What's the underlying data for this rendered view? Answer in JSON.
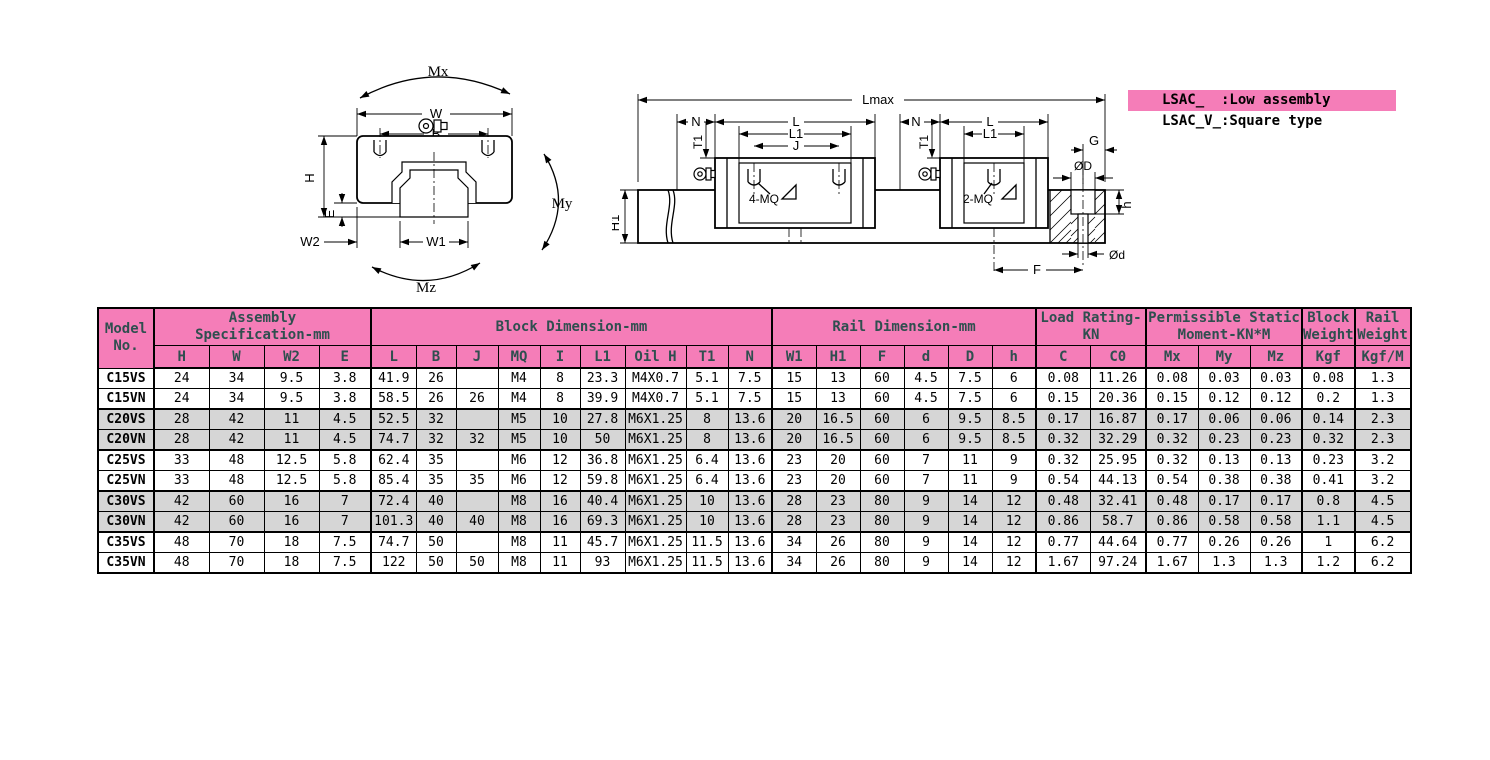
{
  "colors": {
    "header_pink": "#f57db8",
    "legend_pink": "#f78bc0",
    "row_shade": "#d6d6d6",
    "header_text": "#2f4f4f"
  },
  "legend": {
    "line1": "LSAC_  :Low assembly",
    "line2": "LSAC_V_:Square type"
  },
  "diagram": {
    "front_view": {
      "mx": "Mx",
      "w": "W",
      "b": "B",
      "my": "My",
      "h": "H",
      "e": "E",
      "w2": "W2",
      "w1": "W1",
      "mz": "Mz"
    },
    "side_view": {
      "lmax": "Lmax",
      "n_left": "N",
      "t1_left": "T1",
      "l_left": "L",
      "l1_left": "L1",
      "j": "J",
      "mq4": "4-MQ",
      "h1": "H1",
      "n_right": "N",
      "t1_right": "T1",
      "l_right": "L",
      "l1_right": "L1",
      "mq2": "2-MQ",
      "g": "G",
      "dia_D": "ØD",
      "h": "h",
      "dia_d": "Ød",
      "f": "F"
    }
  },
  "table": {
    "model_header": {
      "l1": "Model",
      "l2": "No."
    },
    "groups": [
      {
        "l1": "Assembly",
        "l2": "Specification-mm"
      },
      {
        "l1": "Block Dimension-mm",
        "l2": ""
      },
      {
        "l1": "Rail Dimension-mm",
        "l2": ""
      },
      {
        "l1": "Load Rating-",
        "l2": "KN"
      },
      {
        "l1": "Permissible Static",
        "l2": "Moment-KN*M"
      },
      {
        "l1": "Block",
        "l2": "Weight"
      },
      {
        "l1": "Rail",
        "l2": "Weight"
      }
    ],
    "sub_headers": [
      "H",
      "W",
      "W2",
      "E",
      "L",
      "B",
      "J",
      "MQ",
      "I",
      "L1",
      "Oil H",
      "T1",
      "N",
      "W1",
      "H1",
      "F",
      "d",
      "D",
      "h",
      "C",
      "C0",
      "Mx",
      "My",
      "Mz",
      "Kgf",
      "Kgf/M"
    ],
    "rows": [
      {
        "model": "C15VS",
        "shaded": false,
        "values": [
          "24",
          "34",
          "9.5",
          "3.8",
          "41.9",
          "26",
          "",
          "M4",
          "8",
          "23.3",
          "M4X0.7",
          "5.1",
          "7.5",
          "15",
          "13",
          "60",
          "4.5",
          "7.5",
          "6",
          "0.08",
          "11.26",
          "0.08",
          "0.03",
          "0.03",
          "0.08",
          "1.3"
        ]
      },
      {
        "model": "C15VN",
        "shaded": false,
        "values": [
          "24",
          "34",
          "9.5",
          "3.8",
          "58.5",
          "26",
          "26",
          "M4",
          "8",
          "39.9",
          "M4X0.7",
          "5.1",
          "7.5",
          "15",
          "13",
          "60",
          "4.5",
          "7.5",
          "6",
          "0.15",
          "20.36",
          "0.15",
          "0.12",
          "0.12",
          "0.2",
          "1.3"
        ]
      },
      {
        "model": "C20VS",
        "shaded": true,
        "values": [
          "28",
          "42",
          "11",
          "4.5",
          "52.5",
          "32",
          "",
          "M5",
          "10",
          "27.8",
          "M6X1.25",
          "8",
          "13.6",
          "20",
          "16.5",
          "60",
          "6",
          "9.5",
          "8.5",
          "0.17",
          "16.87",
          "0.17",
          "0.06",
          "0.06",
          "0.14",
          "2.3"
        ]
      },
      {
        "model": "C20VN",
        "shaded": true,
        "values": [
          "28",
          "42",
          "11",
          "4.5",
          "74.7",
          "32",
          "32",
          "M5",
          "10",
          "50",
          "M6X1.25",
          "8",
          "13.6",
          "20",
          "16.5",
          "60",
          "6",
          "9.5",
          "8.5",
          "0.32",
          "32.29",
          "0.32",
          "0.23",
          "0.23",
          "0.32",
          "2.3"
        ]
      },
      {
        "model": "C25VS",
        "shaded": false,
        "values": [
          "33",
          "48",
          "12.5",
          "5.8",
          "62.4",
          "35",
          "",
          "M6",
          "12",
          "36.8",
          "M6X1.25",
          "6.4",
          "13.6",
          "23",
          "20",
          "60",
          "7",
          "11",
          "9",
          "0.32",
          "25.95",
          "0.32",
          "0.13",
          "0.13",
          "0.23",
          "3.2"
        ]
      },
      {
        "model": "C25VN",
        "shaded": false,
        "values": [
          "33",
          "48",
          "12.5",
          "5.8",
          "85.4",
          "35",
          "35",
          "M6",
          "12",
          "59.8",
          "M6X1.25",
          "6.4",
          "13.6",
          "23",
          "20",
          "60",
          "7",
          "11",
          "9",
          "0.54",
          "44.13",
          "0.54",
          "0.38",
          "0.38",
          "0.41",
          "3.2"
        ]
      },
      {
        "model": "C30VS",
        "shaded": true,
        "values": [
          "42",
          "60",
          "16",
          "7",
          "72.4",
          "40",
          "",
          "M8",
          "16",
          "40.4",
          "M6X1.25",
          "10",
          "13.6",
          "28",
          "23",
          "80",
          "9",
          "14",
          "12",
          "0.48",
          "32.41",
          "0.48",
          "0.17",
          "0.17",
          "0.8",
          "4.5"
        ]
      },
      {
        "model": "C30VN",
        "shaded": true,
        "values": [
          "42",
          "60",
          "16",
          "7",
          "101.3",
          "40",
          "40",
          "M8",
          "16",
          "69.3",
          "M6X1.25",
          "10",
          "13.6",
          "28",
          "23",
          "80",
          "9",
          "14",
          "12",
          "0.86",
          "58.7",
          "0.86",
          "0.58",
          "0.58",
          "1.1",
          "4.5"
        ]
      },
      {
        "model": "C35VS",
        "shaded": false,
        "values": [
          "48",
          "70",
          "18",
          "7.5",
          "74.7",
          "50",
          "",
          "M8",
          "11",
          "45.7",
          "M6X1.25",
          "11.5",
          "13.6",
          "34",
          "26",
          "80",
          "9",
          "14",
          "12",
          "0.77",
          "44.64",
          "0.77",
          "0.26",
          "0.26",
          "1",
          "6.2"
        ]
      },
      {
        "model": "C35VN",
        "shaded": false,
        "values": [
          "48",
          "70",
          "18",
          "7.5",
          "122",
          "50",
          "50",
          "M8",
          "11",
          "93",
          "M6X1.25",
          "11.5",
          "13.6",
          "34",
          "26",
          "80",
          "9",
          "14",
          "12",
          "1.67",
          "97.24",
          "1.67",
          "1.3",
          "1.3",
          "1.2",
          "6.2"
        ]
      }
    ]
  }
}
